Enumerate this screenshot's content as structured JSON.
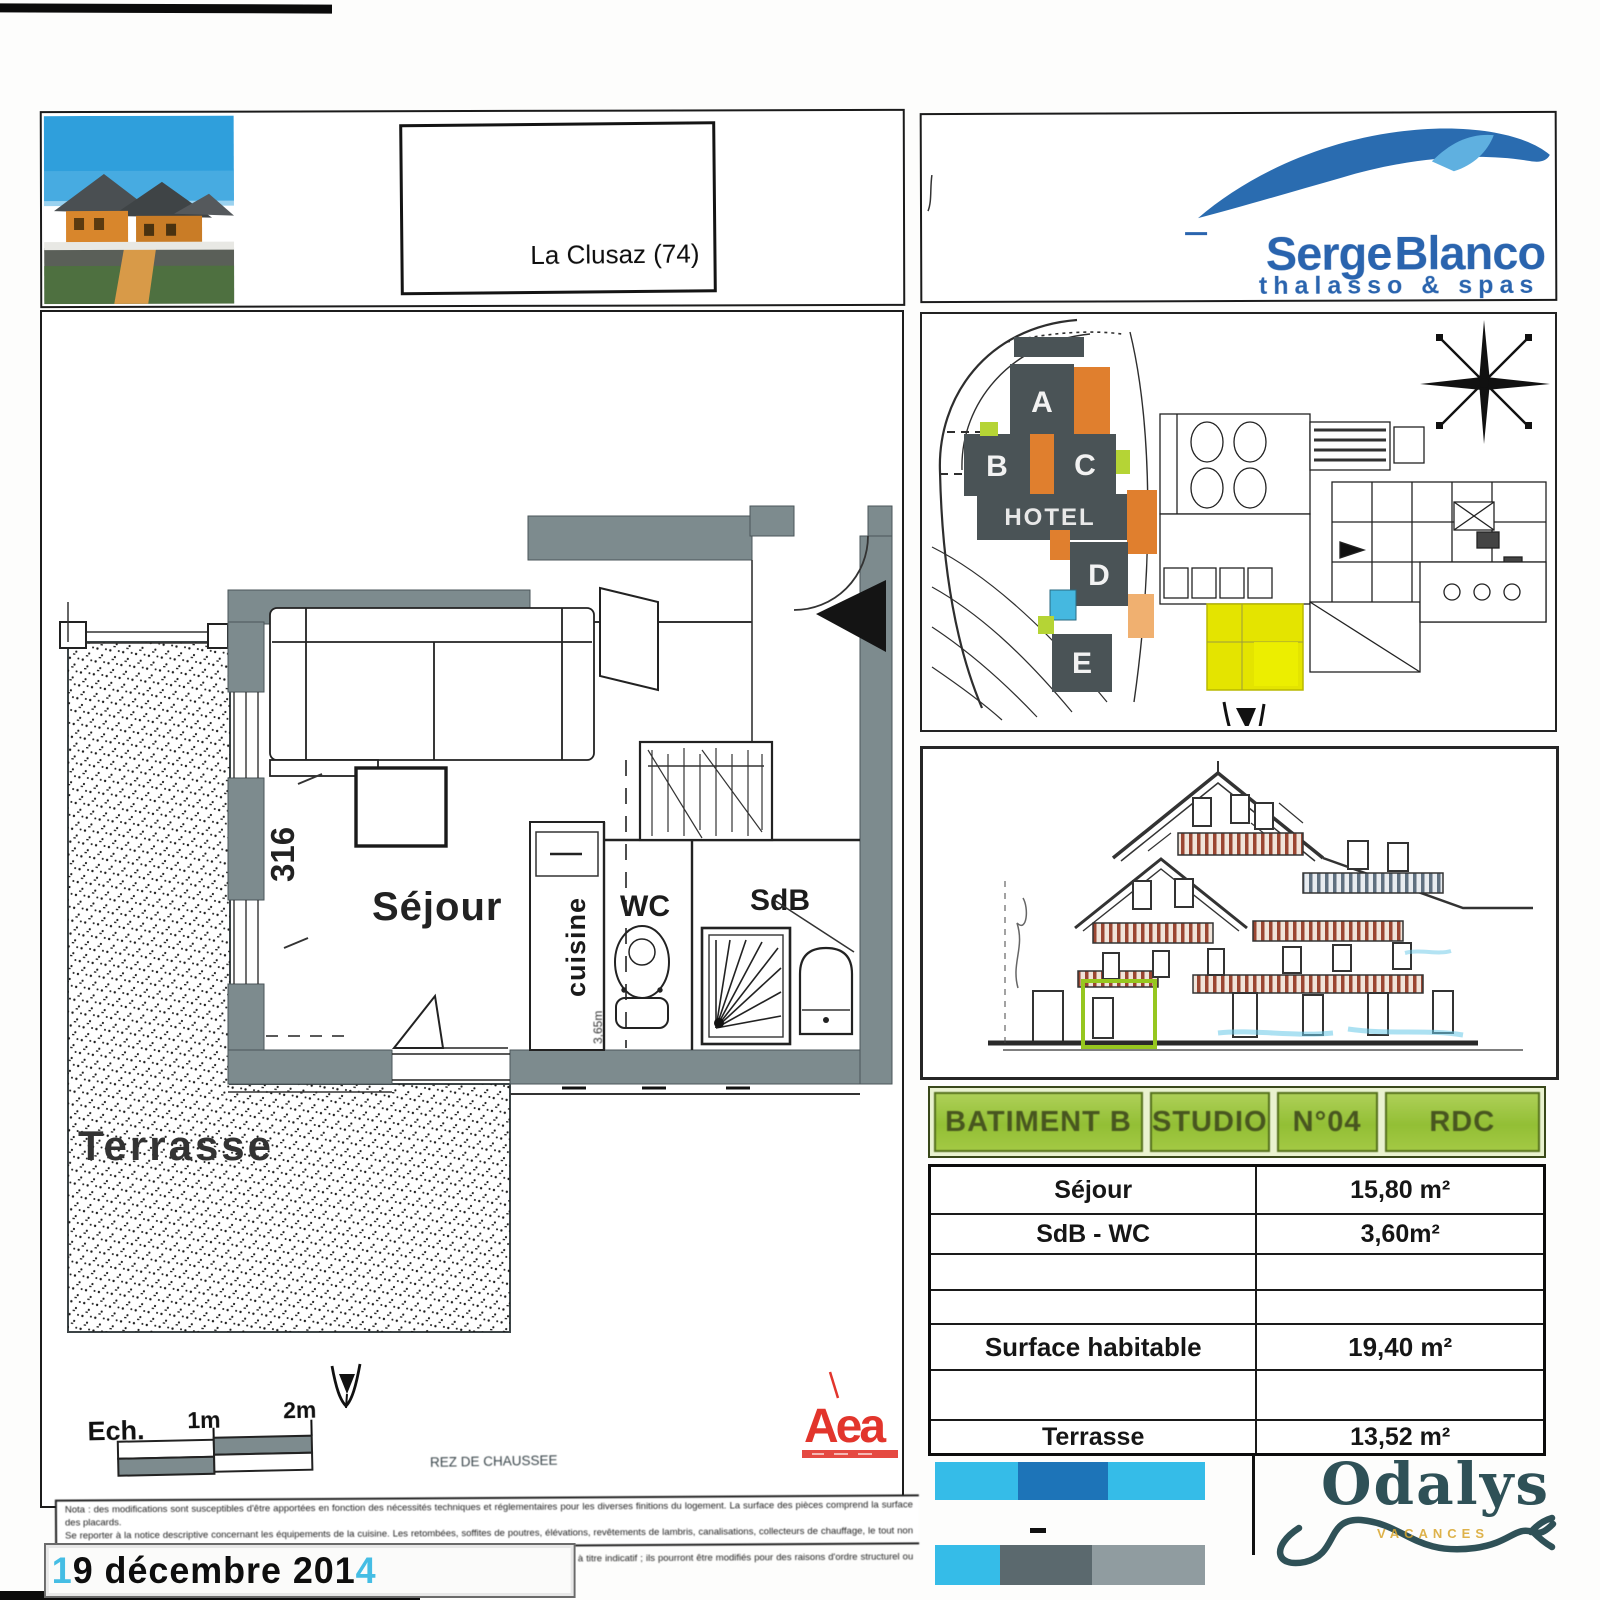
{
  "header": {
    "location_label": "La Clusaz (74)"
  },
  "brand": {
    "word1": "Serge",
    "word2": "Blanco",
    "tagline": "thalasso & spas"
  },
  "floor_plan": {
    "labels": {
      "sejour": "Séjour",
      "wc": "WC",
      "sdb": "SdB",
      "cuisine": "cuisine",
      "terrasse": "Terrasse"
    },
    "dim_width": "602",
    "dim_height": "316",
    "kitchen_dim": "3,65m",
    "scale": {
      "label": "Ech.",
      "mark1": "1m",
      "mark2": "2m"
    },
    "caption": "REZ DE CHAUSSEE"
  },
  "stamp_logo": {
    "text": "Aea"
  },
  "site_plan": {
    "buildings": [
      "A",
      "B",
      "C",
      "D",
      "E"
    ],
    "hotel": "HOTEL"
  },
  "unit_table": {
    "header": [
      "BATIMENT B",
      "STUDIO",
      "N°04",
      "RDC"
    ],
    "rows": [
      {
        "label": "Séjour",
        "value": "15,80 m²"
      },
      {
        "label": "SdB - WC",
        "value": "3,60m²"
      },
      {
        "label": "",
        "value": ""
      },
      {
        "label": "",
        "value": ""
      },
      {
        "label": "Surface habitable",
        "value": "19,40 m²"
      },
      {
        "label": "",
        "value": ""
      },
      {
        "label": "Terrasse",
        "value": "13,52 m²"
      }
    ]
  },
  "odalys": {
    "name": "Odalys",
    "subtext": "VACANCES"
  },
  "footer": {
    "disclaimer_lines": [
      "Nota : des modifications sont susceptibles d'être apportées en fonction des nécessités techniques et réglementaires pour les diverses finitions du logement. La surface des pièces comprend la surface des placards.",
      "Se reporter à la notice descriptive concernant les équipements de la cuisine. Les retombées, soffites de poutres, élévations, revêtements de lambris, canalisations, collecteurs de chauffage, le tout non figuré.",
      "Les soffites et faux-plafonds sont susceptibles d'être modifiés. Les seuils ou marches ou petites fenêtres sont présentés à titre indicatif ; ils pourront être modifiés pour des raisons d'ordre structurel ou réglementaire."
    ],
    "date": {
      "lead": "1",
      "main": "9 décembre 201",
      "tail": "4"
    }
  },
  "colors": {
    "wall_gray": "#7d8b8e",
    "green_header": "#9cc53e",
    "yellow_unit": "#e4e400",
    "serge_blue": "#2a64ae",
    "wave_light": "#5fb0e0",
    "odalys_teal": "#2f5157",
    "stamp_red": "#e2352c",
    "bar_cyan": "#35bce8",
    "bar_blue": "#1d74b8",
    "bar_darkgray": "#5b696e",
    "bar_gray": "#909ca0",
    "site_orange": "#e07f2e"
  }
}
